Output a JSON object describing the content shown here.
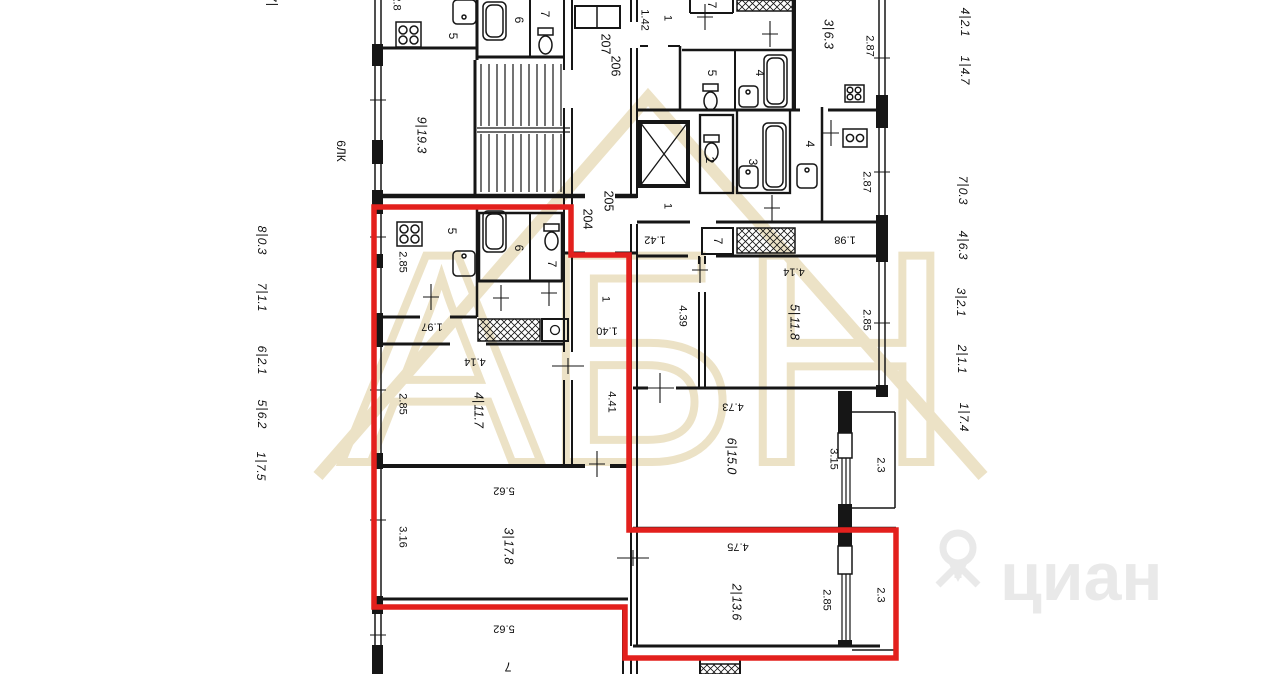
{
  "plan": {
    "stairwell_label": "6ЛК",
    "margin_left": [
      {
        "n": "7",
        "d": ""
      },
      {
        "n": "8",
        "d": "0.3"
      },
      {
        "n": "7",
        "d": "1.1"
      },
      {
        "n": "6",
        "d": "2.1"
      },
      {
        "n": "5",
        "d": "6.2"
      },
      {
        "n": "1",
        "d": "7.5"
      }
    ],
    "margin_right": [
      {
        "n": "4",
        "d": "2.1"
      },
      {
        "n": "1",
        "d": "4.7"
      },
      {
        "n": "7",
        "d": "0.3"
      },
      {
        "n": "4",
        "d": "6.3"
      },
      {
        "n": "3",
        "d": "2.1"
      },
      {
        "n": "2",
        "d": "1.1"
      },
      {
        "n": "1",
        "d": "7.4"
      }
    ],
    "room_areas": [
      {
        "n": "9",
        "d": "19.3"
      },
      {
        "n": "4",
        "d": "11.7"
      },
      {
        "n": "3",
        "d": "17.8"
      },
      {
        "n": "5",
        "d": "11.8"
      },
      {
        "n": "6",
        "d": "15.0"
      },
      {
        "n": "2",
        "d": "13.6"
      },
      {
        "n": "3",
        "d": "6.3"
      }
    ],
    "unit_numbers": [
      "207",
      "206",
      "205",
      "204"
    ],
    "dims_v": [
      "2.8",
      "2.85",
      "2.85",
      "3.16",
      "2.87",
      "2.87",
      "2.85",
      "4.39",
      "4.41",
      "3.15",
      "2.3",
      "2.85",
      "2.3",
      "1.42"
    ],
    "dims_flipped": [
      "1.97",
      "1.40",
      "4.14",
      "4.14",
      "1.98",
      "1.42",
      "4.73",
      "5.62",
      "5.62",
      "4.75",
      "7"
    ],
    "room_tags": [
      "5",
      "6",
      "7",
      "5",
      "6",
      "7",
      "5",
      "4",
      "2",
      "3",
      "4",
      "7",
      "7"
    ],
    "ones": [
      "1",
      "1",
      "1"
    ]
  },
  "watermarks": {
    "brand_outline": "АБН",
    "portal": "циан"
  },
  "colors": {
    "wall": "#161616",
    "highlight_red": "#e3201d",
    "watermark_beige": "#ece2c6",
    "watermark_gray": "#e9e9e9"
  }
}
